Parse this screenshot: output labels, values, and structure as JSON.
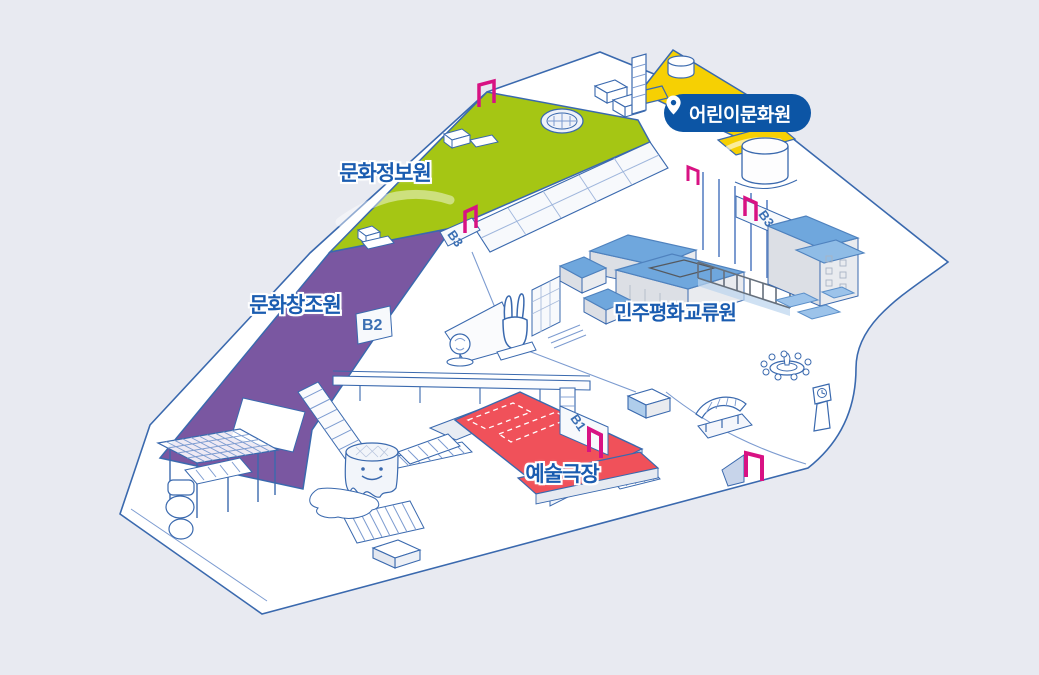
{
  "colors": {
    "background": "#E8EAF1",
    "outline": "#3A69AE",
    "outline_light": "#7C9BD0",
    "green": "#A5C614",
    "purple": "#7A57A1",
    "yellow": "#F6D003",
    "red": "#F0515A",
    "roof_blue": "#6FA7DD",
    "magenta": "#D81283",
    "label_blue": "#1A5CB0",
    "badge_blue": "#0C55A5",
    "wall_light": "#F7F9FC",
    "wall_gray": "#E2E5EB"
  },
  "marker_badge": {
    "label": "어린이문화원",
    "icon": "location-pin-icon"
  },
  "area_labels": [
    {
      "id": "culture-information-center",
      "label": "문화정보원"
    },
    {
      "id": "culture-creation-center",
      "label": "문화창조원"
    },
    {
      "id": "democracy-peace-exchange-center",
      "label": "민주평화교류원"
    },
    {
      "id": "arts-theater",
      "label": "예술극장"
    }
  ],
  "floor_markers": [
    {
      "label": "B3"
    },
    {
      "label": "B3"
    },
    {
      "label": "B2"
    },
    {
      "label": "B1"
    }
  ]
}
